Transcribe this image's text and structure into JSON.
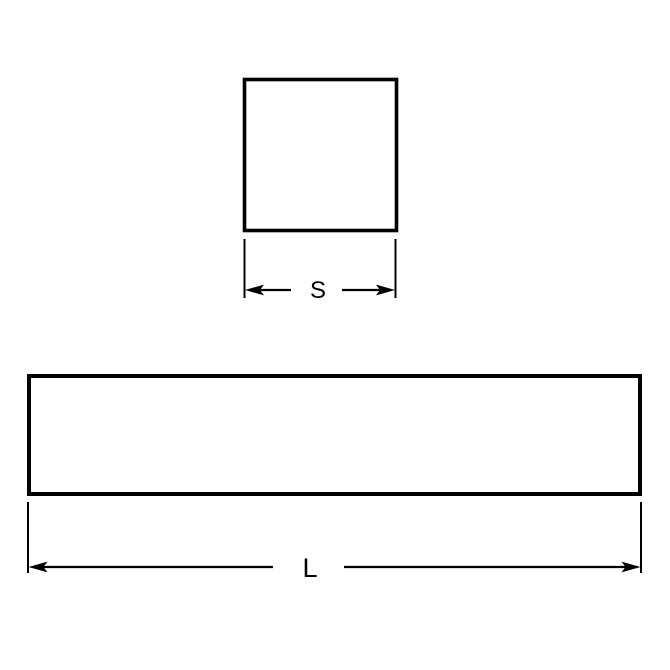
{
  "diagram": {
    "description": "Technical drawing of square bar keystock: square cross-section and side-view length",
    "background_color": "#ffffff",
    "line_color": "#000000",
    "cross_section": {
      "shape": "square",
      "dimension_label": "S"
    },
    "side_view": {
      "shape": "rectangle",
      "dimension_label": "L"
    }
  }
}
